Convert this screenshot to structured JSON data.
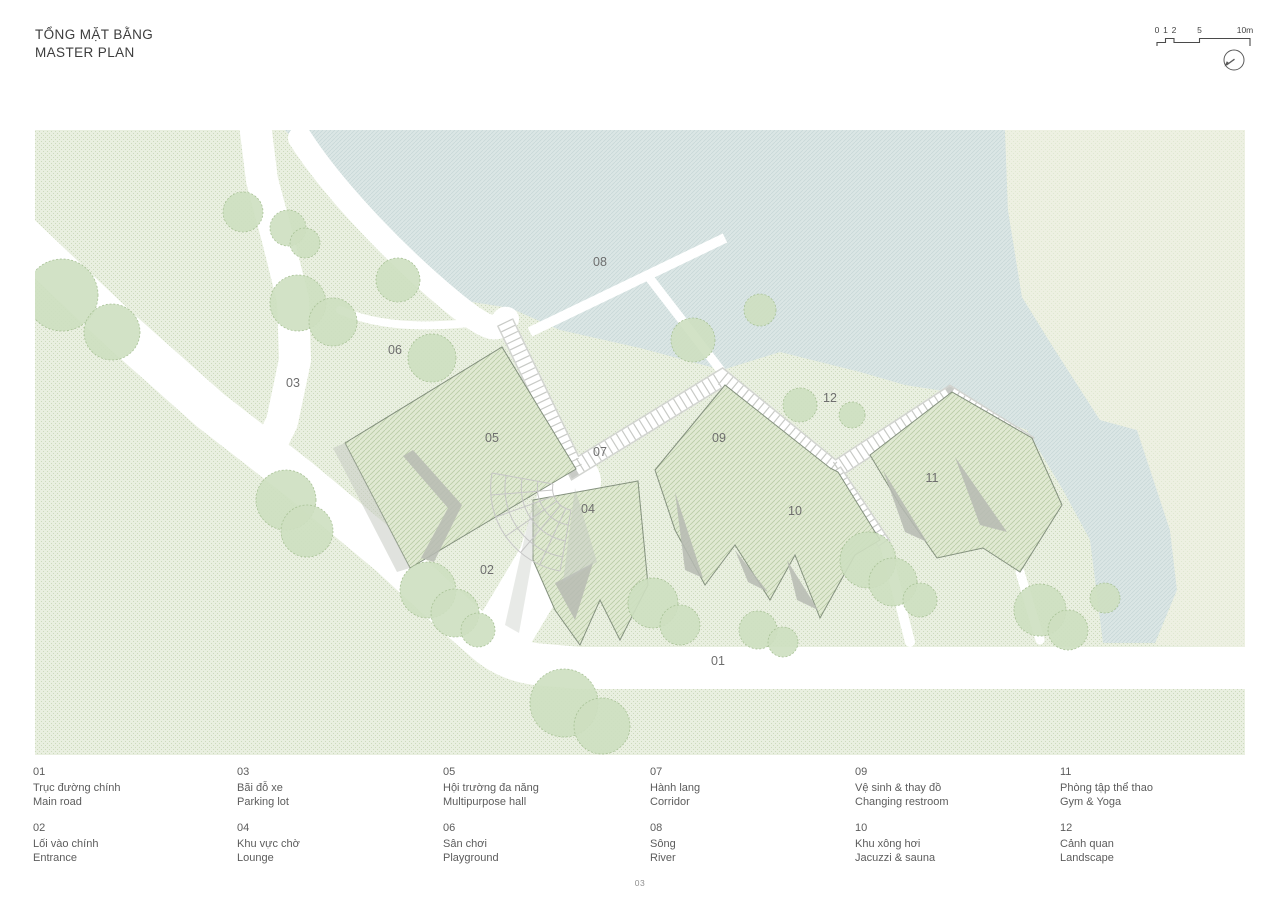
{
  "header": {
    "title_line1": "TỔNG MẶT BẰNG",
    "title_line2": "MASTER PLAN"
  },
  "scale_bar": {
    "tick_labels": [
      "0",
      "1",
      "2",
      "5",
      "10m"
    ]
  },
  "plan_markers": [
    {
      "label": "01"
    },
    {
      "label": "02"
    },
    {
      "label": "03"
    },
    {
      "label": "04"
    },
    {
      "label": "05"
    },
    {
      "label": "06"
    },
    {
      "label": "07"
    },
    {
      "label": "08"
    },
    {
      "label": "09"
    },
    {
      "label": "10"
    },
    {
      "label": "11"
    },
    {
      "label": "12"
    }
  ],
  "legend_items": [
    {
      "num": "01",
      "vi": "Trục đường chính",
      "en": "Main road"
    },
    {
      "num": "02",
      "vi": "Lối vào chính",
      "en": "Entrance"
    },
    {
      "num": "03",
      "vi": "Bãi đỗ xe",
      "en": "Parking lot"
    },
    {
      "num": "04",
      "vi": "Khu vực chờ",
      "en": "Lounge"
    },
    {
      "num": "05",
      "vi": "Hội trường đa năng",
      "en": "Multipurpose hall"
    },
    {
      "num": "06",
      "vi": "Sân chơi",
      "en": "Playground"
    },
    {
      "num": "07",
      "vi": "Hành lang",
      "en": "Corridor"
    },
    {
      "num": "08",
      "vi": "Sông",
      "en": "River"
    },
    {
      "num": "09",
      "vi": "Vệ sinh & thay đồ",
      "en": "Changing restroom"
    },
    {
      "num": "10",
      "vi": "Khu xông hơi",
      "en": "Jacuzzi & sauna"
    },
    {
      "num": "11",
      "vi": "Phòng tập thể thao",
      "en": "Gym & Yoga"
    },
    {
      "num": "12",
      "vi": "Cảnh quan",
      "en": "Landscape"
    }
  ],
  "footer": {
    "page_number": "03"
  },
  "colors": {
    "grass": "#e9efe0",
    "water": "#dbe6e5",
    "pale_green": "#edf0e2",
    "roof_green": "#e0e9d2",
    "tree_green": "#cddfc0",
    "shadow_gray": "#b7bbb3",
    "road_white": "#ffffff",
    "text_gray": "#5c5c5c"
  }
}
